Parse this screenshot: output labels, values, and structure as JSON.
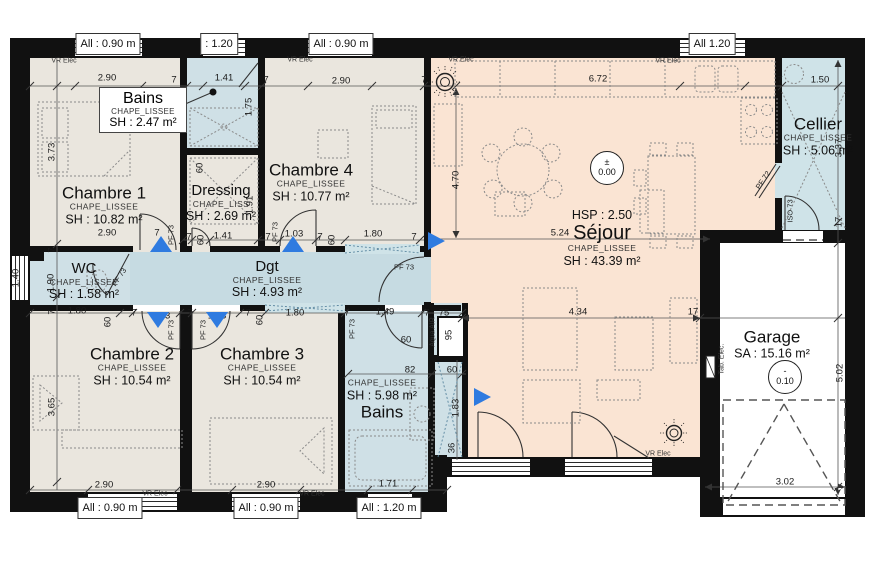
{
  "colors": {
    "wall": "#111111",
    "bedroom": "#eae6de",
    "wet": "#cfe0e6",
    "corridor": "#c6dbe2",
    "sejour": "#fae4d3",
    "cellier": "#cfe3e8",
    "garage": "#ffffff",
    "arrow": "#2f7be0"
  },
  "rooms": {
    "bains_top": {
      "name": "Bains",
      "finish": "CHAPE_LISSEE",
      "area": "SH : 2.47 m²"
    },
    "chambre1": {
      "name": "Chambre 1",
      "finish": "CHAPE_LISSEE",
      "area": "SH : 10.82 m²"
    },
    "dressing": {
      "name": "Dressing",
      "finish": "CHAPE_LISS",
      "area": "SH : 2.69 m²"
    },
    "chambre4": {
      "name": "Chambre 4",
      "finish": "CHAPE_LISSEE",
      "area": "SH : 10.77 m²"
    },
    "wc": {
      "name": "WC",
      "finish": "CHAPE_LISSEE",
      "area": "SH : 1.58 m²"
    },
    "dgt": {
      "name": "Dgt",
      "finish": "CHAPE_LISSEE",
      "area": "SH : 4.93 m²"
    },
    "chambre2": {
      "name": "Chambre 2",
      "finish": "CHAPE_LISSEE",
      "area": "SH : 10.54 m²"
    },
    "chambre3": {
      "name": "Chambre 3",
      "finish": "CHAPE_LISSEE",
      "area": "SH : 10.54 m²"
    },
    "bains_bottom": {
      "name": "Bains",
      "finish": "CHAPE_LISSEE",
      "area": "SH : 5.98 m²"
    },
    "sejour": {
      "name": "Séjour",
      "hsp": "HSP : 2.50",
      "finish": "CHAPE_LISSEE",
      "area": "SH : 43.39 m²"
    },
    "cellier": {
      "name": "Cellier",
      "finish": "CHAPE_LISSEE",
      "area": "SH : 5.06 m²"
    },
    "garage": {
      "name": "Garage",
      "area": "SA : 15.16 m²"
    }
  },
  "levels": {
    "sejour": {
      "sign": "±",
      "value": "0.00"
    },
    "garage": {
      "sign": "-",
      "value": "0.10"
    }
  },
  "windows": {
    "w090": "All : 0.90 m",
    "w120c": ": 1.20",
    "w120": "All 1.20",
    "w120m": "All : 1.20 m"
  },
  "doors": {
    "pf73": "PF 73",
    "pf72": "PF 72",
    "iso73": "ISO 73"
  },
  "tech": {
    "vr": "VR Elec",
    "tab": "Tab. Elec.",
    "aqua": "Aqua AIR"
  },
  "dims": {
    "d7": "7",
    "d17": "17",
    "d36": "36",
    "d60": "60",
    "d75": "75",
    "d82": "82",
    "d95": "95",
    "d103": "1.03",
    "d140": "1.40",
    "d141": "1.41",
    "d149": "1.49",
    "d150": "1.50",
    "d171": "1.71",
    "d175": "1.75",
    "d180": "1.80",
    "d183": "1.83",
    "d190": "1.90",
    "d191": "1.91",
    "d290": "2.90",
    "d302": "3.02",
    "d337": "3.37",
    "d365": "3.65",
    "d373": "3.73",
    "d434": "4.34",
    "d470": "4.70",
    "d502": "5.02",
    "d524": "5.24",
    "d672": "6.72"
  }
}
